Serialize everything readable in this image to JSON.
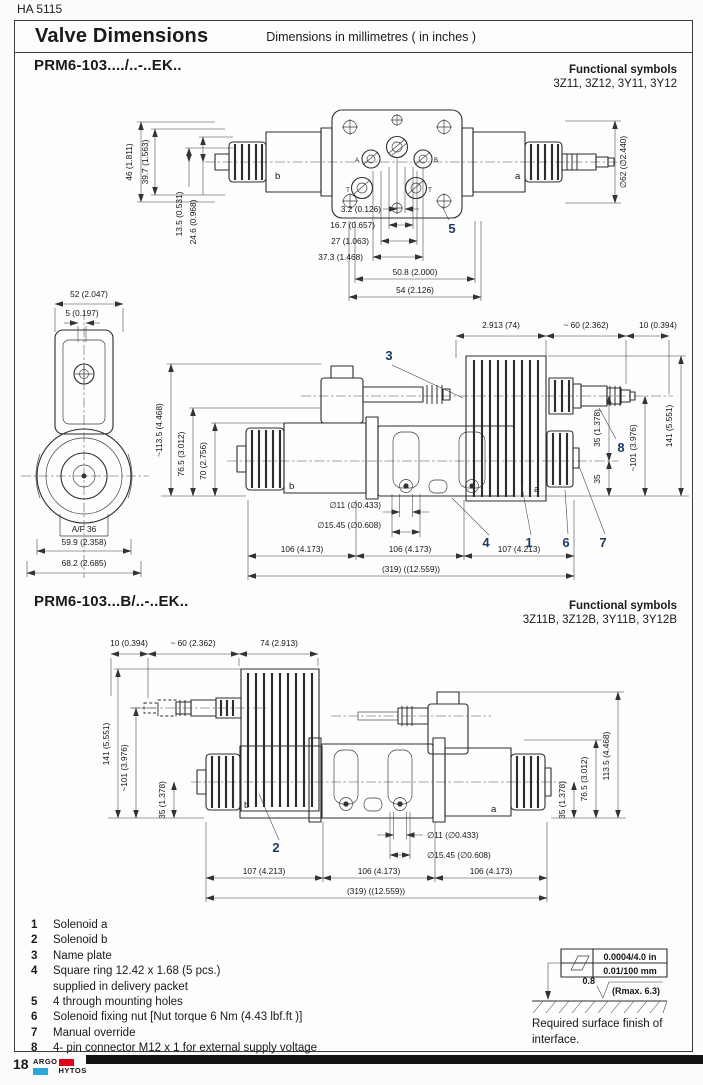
{
  "page": {
    "doc_code": "HA 5115",
    "title": "Valve Dimensions",
    "subtitle": "Dimensions in millimetres ( in inches )",
    "page_number": "18",
    "logo": {
      "argo": "ARGO",
      "hytos": "HYTOS"
    },
    "colors": {
      "logo_red": "#e2001a",
      "logo_blue": "#29a8df",
      "callout": "#1d3a67",
      "line": "#2d2d2d"
    }
  },
  "section1": {
    "title": "PRM6-103..../..-..EK..",
    "functional_symbols_label": "Functional symbols",
    "functional_symbols_values": "3Z11, 3Z12, 3Y11, 3Y12"
  },
  "section2": {
    "title": "PRM6-103...B/..-..EK..",
    "functional_symbols_label": "Functional symbols",
    "functional_symbols_values": "3Z11B, 3Z12B, 3Y11B, 3Y12B"
  },
  "top_view": {
    "dim_46": "46 (1.811)",
    "dim_39_7": "39.7 (1.563)",
    "dim_13_5": "13.5 (0.531)",
    "dim_24_6": "24.6 (0.968)",
    "dim_3_2": "3.2 (0.126)",
    "dim_16_7": "16.7 (0.657)",
    "dim_27": "27 (1.063)",
    "dim_37_3": "37.3 (1.468)",
    "dim_50_8": "50.8 (2.000)",
    "dim_54": "54 (2.126)",
    "dim_dia62": "∅62 (∅2.440)",
    "label_a": "a",
    "label_b": "b",
    "callout_5": "5",
    "port_a": "A",
    "port_b": "B",
    "port_t1": "T",
    "port_t2": "T"
  },
  "end_view": {
    "dim_52": "52 (2.047)",
    "dim_5": "5 (0.197)",
    "af36": "A/F 36",
    "dim_59_9": "59.9 (2.358)",
    "dim_68_2": "68.2 (2.685)"
  },
  "front_view1": {
    "dim_74": "2.913 (74)",
    "dim_60": "~ 60 (2.362)",
    "dim_10": "10 (0.394)",
    "dim_113_5": "~113.5 (4.468)",
    "dim_76_5": "76.5 (3.012)",
    "dim_70": "70 (2.756)",
    "dim_35a": "35 (1.378)",
    "dim_101": "~101 (3.976)",
    "dim_141": "141 (5.551)",
    "dim_35b": "35",
    "dim_dia11": "∅11 (∅0.433)",
    "dim_dia15_45": "∅15.45 (∅0.608)",
    "dim_106a": "106 (4.173)",
    "dim_106b": "106 (4.173)",
    "dim_107": "107 (4.213)",
    "dim_319": "(319) ((12.559))",
    "callout_1": "1",
    "callout_3": "3",
    "callout_4": "4",
    "callout_6": "6",
    "callout_7": "7",
    "callout_8": "8",
    "label_a": "a",
    "label_b": "b"
  },
  "front_view2": {
    "dim_10": "10 (0.394)",
    "dim_60": "~ 60 (2.362)",
    "dim_74": "74 (2.913)",
    "dim_141": "141 (5.551)",
    "dim_101": "~101 (3.976)",
    "dim_35l": "35 (1.378)",
    "dim_35r": "35 (1.378)",
    "dim_76_5": "76.5 (3.012)",
    "dim_113_5": "113.5 (4.468)",
    "dim_dia11": "∅11 (∅0.433)",
    "dim_dia15_45": "∅15.45 (∅0.608)",
    "dim_107": "107 (4.213)",
    "dim_106a": "106 (4.173)",
    "dim_106b": "106 (4.173)",
    "dim_319": "(319) ((12.559))",
    "callout_2": "2",
    "label_a": "a",
    "label_b": "b"
  },
  "legend": {
    "items": [
      {
        "num": "1",
        "text": "Solenoid a"
      },
      {
        "num": "2",
        "text": "Solenoid b"
      },
      {
        "num": "3",
        "text": "Name plate"
      },
      {
        "num": "4",
        "text": "Square ring 12.42 x 1.68 (5 pcs.)",
        "text2": "supplied in delivery packet"
      },
      {
        "num": "5",
        "text": "4 through mounting holes"
      },
      {
        "num": "6",
        "text": "Solenoid fixing nut  [Nut torque 6 Nm (4.43 lbf.ft )]"
      },
      {
        "num": "7",
        "text": "Manual override"
      },
      {
        "num": "8",
        "text": "4- pin connector M12 x 1 for external supply voltage"
      }
    ]
  },
  "surface_finish": {
    "flatness_in": "0.0004/4.0 in",
    "flatness_mm": "0.01/100 mm",
    "roughness": "0.8",
    "rmax": "(Rmax. 6.3)",
    "caption_line1": "Required surface finish of",
    "caption_line2": "interface."
  }
}
